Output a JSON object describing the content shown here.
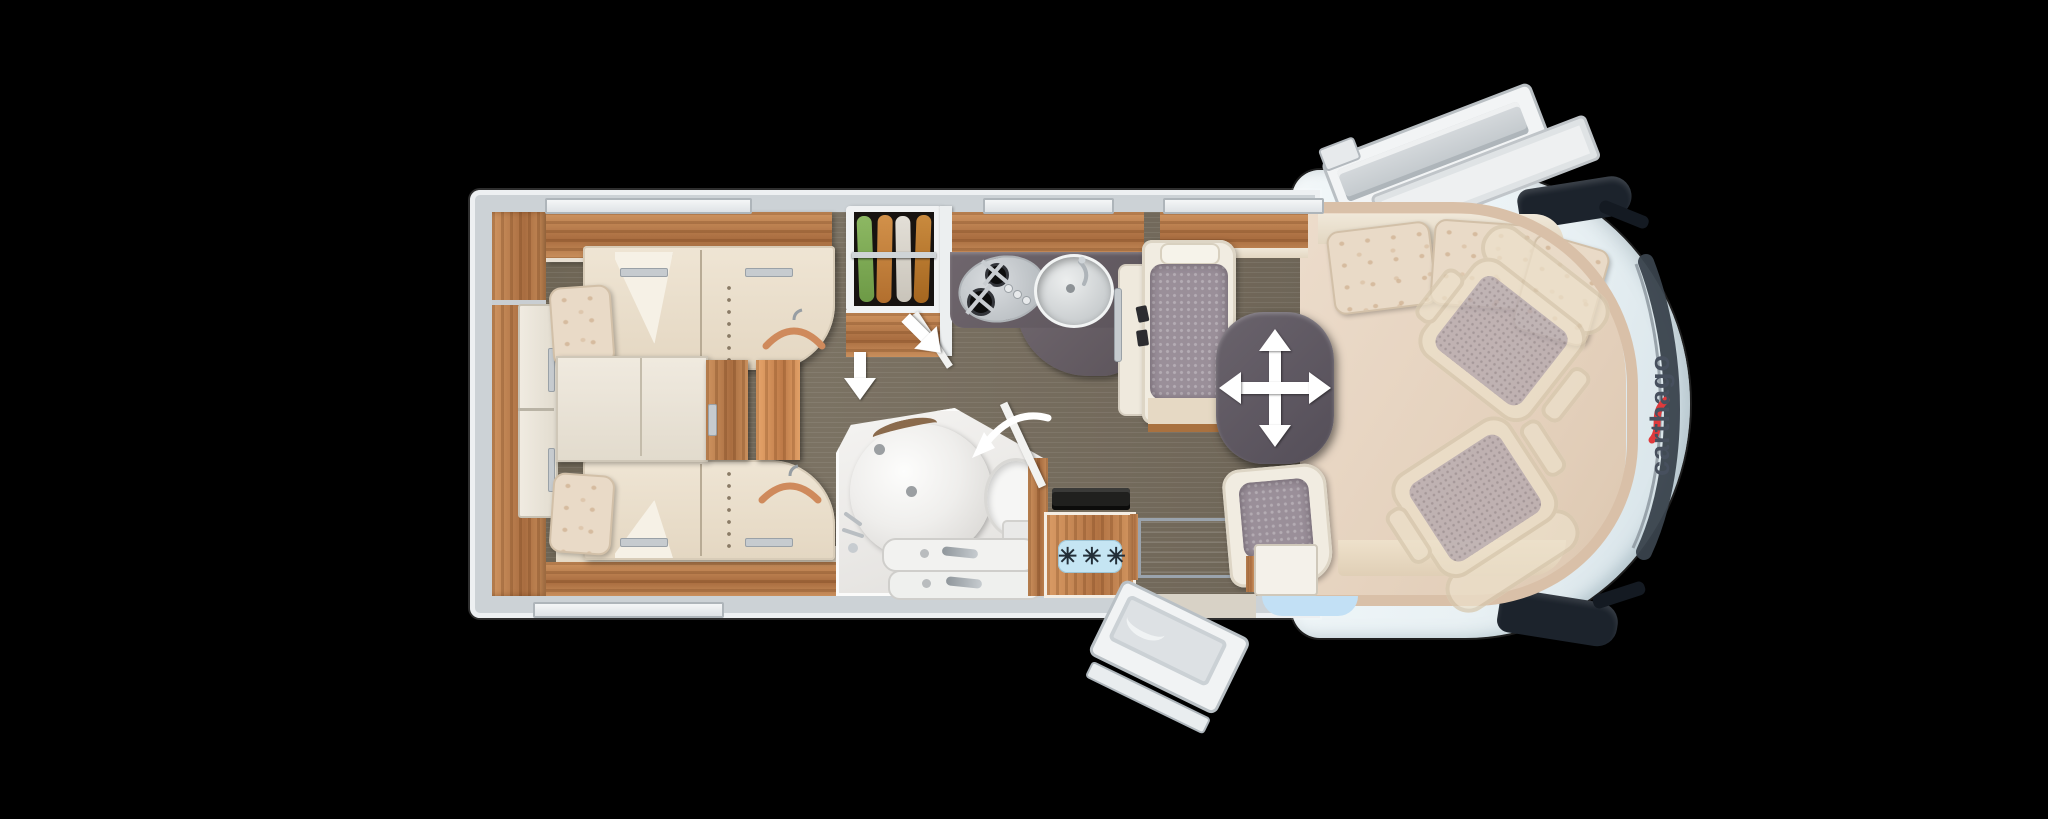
{
  "canvas": {
    "width": 2048,
    "height": 819,
    "background": "#000000"
  },
  "branding": {
    "logo_text": "carthago",
    "logo_color": "#47505e",
    "logo_accent_color": "#df3a3c"
  },
  "appliances": {
    "freezer_label": "✳✳✳"
  },
  "palette": {
    "wall": "#ccd2d6",
    "wood_light": "#cf9460",
    "wood_dark": "#a96d40",
    "floor_dark": "#716856",
    "upholstery_cream": "#ece2d0",
    "cushion_gray": "#9a8f99",
    "table_anthracite": "#5d5761",
    "cab_body": "#eaf2f5",
    "entry_step_well": "#262e3b",
    "freezer_label_bg": "#c5e5f3",
    "overlay_arrow": "#ffffff",
    "hanger_orange": "#cf8a5c",
    "wardrobe_clothes": [
      "#7fae56",
      "#c5823b",
      "#d9d5cd",
      "#ba7a33"
    ]
  },
  "icons": {
    "walkway_arrow": "↓",
    "door_open_arrow": "↘",
    "door_swing_arrow": "⤺",
    "table_move_arrow": "✛",
    "clothes_hanger": "⌒",
    "freezer_stars": "✳"
  }
}
